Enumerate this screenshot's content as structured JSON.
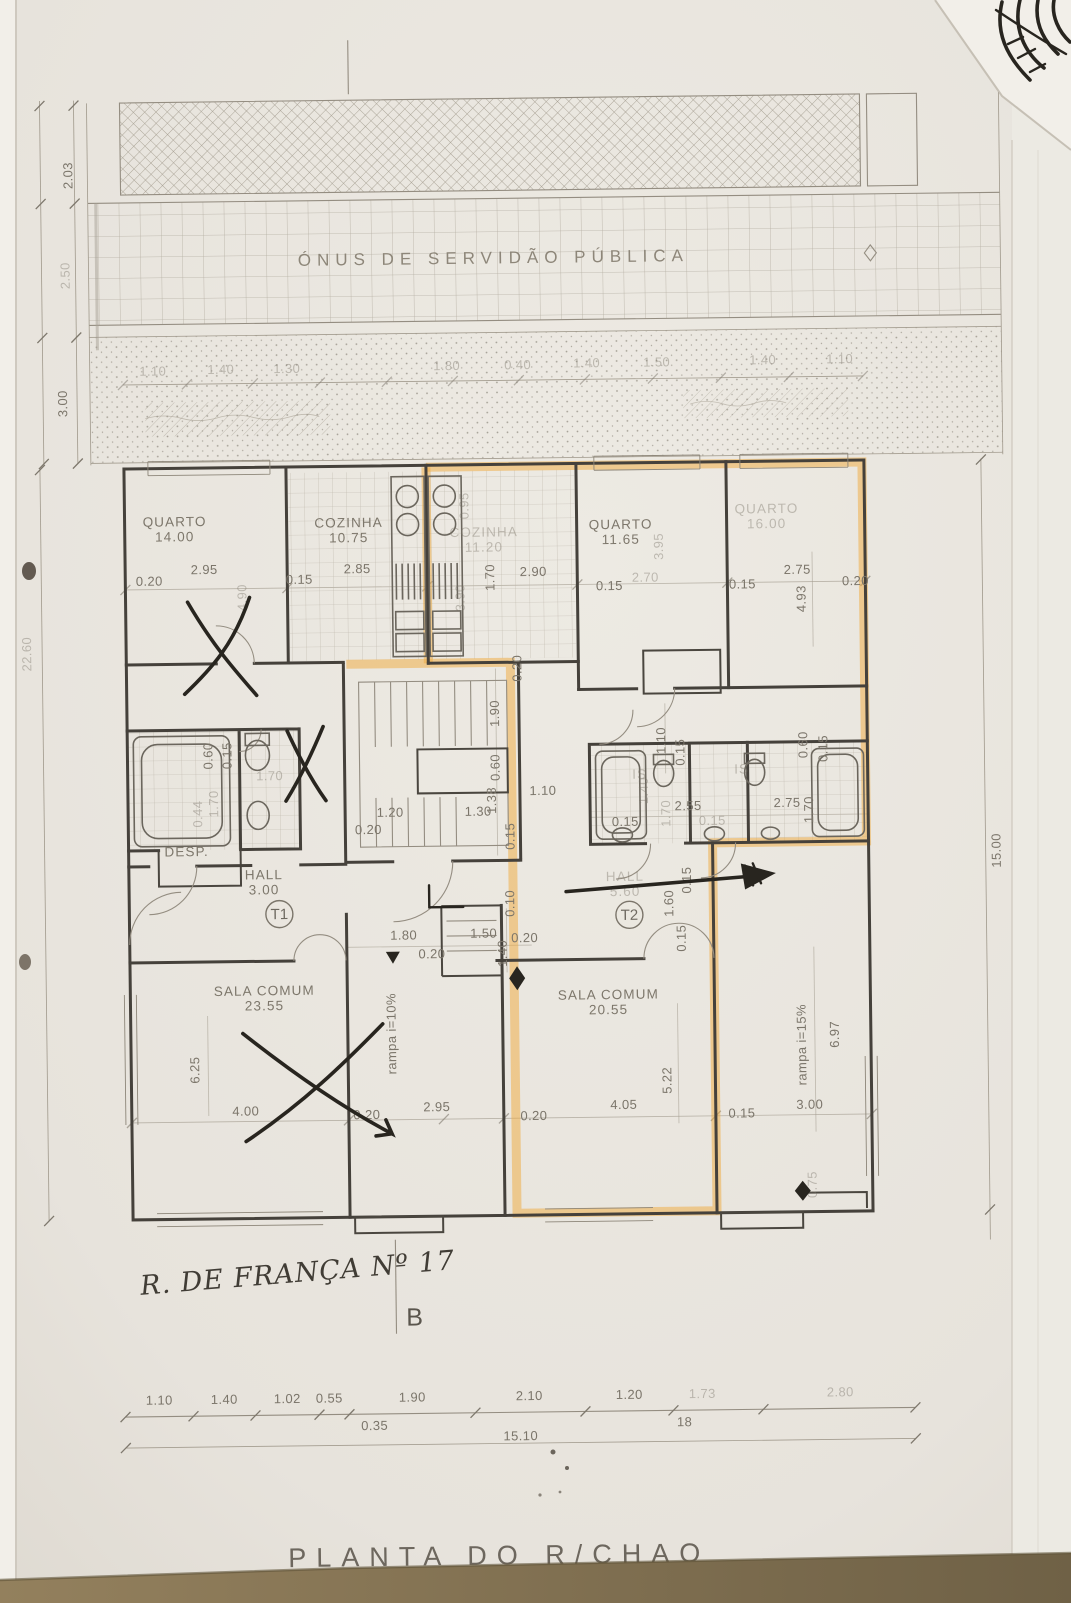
{
  "page": {
    "title": "PLANTA DO R/CHAO",
    "handwritten_note": "R. DE FRANÇA Nº 17",
    "section_marker": "B",
    "servitude_band_label": "ÓNUS DE SERVIDÃO PÚBLICA"
  },
  "rooms": [
    {
      "label": "QUARTO",
      "area": "14.00",
      "x": 178,
      "y": 522
    },
    {
      "label": "COZINHA",
      "area": "10.75",
      "x": 352,
      "y": 525
    },
    {
      "label": "COZINHA",
      "area": "11.20",
      "x": 487,
      "y": 536,
      "f": true
    },
    {
      "label": "QUARTO",
      "area": "11.65",
      "x": 624,
      "y": 530
    },
    {
      "label": "QUARTO",
      "area": "16.00",
      "x": 770,
      "y": 516,
      "f": true
    },
    {
      "label": "SALA COMUM",
      "area": "23.55",
      "x": 262,
      "y": 992
    },
    {
      "label": "SALA COMUM",
      "area": "20.55",
      "x": 606,
      "y": 1000
    },
    {
      "label": "HALL",
      "area": "3.00",
      "x": 263,
      "y": 876
    },
    {
      "label": "HALL",
      "area": "5.60",
      "x": 624,
      "y": 882,
      "f": true
    },
    {
      "label": "DESP.",
      "area": "",
      "x": 186,
      "y": 852
    },
    {
      "label": "IS",
      "area": "",
      "x": 640,
      "y": 780,
      "f": true
    },
    {
      "label": "IS",
      "area": "",
      "x": 742,
      "y": 776,
      "f": true
    }
  ],
  "unit_markers": [
    {
      "label": "T1",
      "x": 278,
      "y": 911
    },
    {
      "label": "T2",
      "x": 628,
      "y": 916
    }
  ],
  "ramp_labels": [
    {
      "label": "rampa i=10%",
      "x": 393,
      "y": 1032
    },
    {
      "label": "rampa i=15%",
      "x": 803,
      "y": 1048
    }
  ],
  "dimensions": [
    {
      "v": "2.03",
      "x": 80,
      "y": 170,
      "r": -90
    },
    {
      "v": "2.50",
      "x": 76,
      "y": 270,
      "r": -90,
      "f": true
    },
    {
      "v": "3.00",
      "x": 72,
      "y": 398,
      "r": -90
    },
    {
      "v": "22.60",
      "x": 33,
      "y": 648,
      "r": -90,
      "f": true
    },
    {
      "v": "15.00",
      "x": 1000,
      "y": 856,
      "r": -90
    },
    {
      "v": "1.10",
      "x": 158,
      "y": 371,
      "f": true
    },
    {
      "v": "1.40",
      "x": 226,
      "y": 370,
      "f": true
    },
    {
      "v": "1.30",
      "x": 292,
      "y": 370,
      "f": true
    },
    {
      "v": "1.80",
      "x": 452,
      "y": 369,
      "f": true
    },
    {
      "v": "0.40",
      "x": 523,
      "y": 369,
      "f": true
    },
    {
      "v": "1.40",
      "x": 592,
      "y": 368,
      "f": true
    },
    {
      "v": "1.50",
      "x": 662,
      "y": 368,
      "f": true
    },
    {
      "v": "1.40",
      "x": 768,
      "y": 367,
      "f": true
    },
    {
      "v": "1.10",
      "x": 845,
      "y": 367,
      "f": true
    },
    {
      "v": "0.20",
      "x": 152,
      "y": 581
    },
    {
      "v": "2.95",
      "x": 207,
      "y": 570
    },
    {
      "v": "4.90",
      "x": 249,
      "y": 594,
      "r": -90,
      "f": true
    },
    {
      "v": "0.15",
      "x": 302,
      "y": 581
    },
    {
      "v": "2.85",
      "x": 360,
      "y": 571
    },
    {
      "v": "3.90",
      "x": 467,
      "y": 597,
      "r": -90,
      "f": true
    },
    {
      "v": "1.70",
      "x": 497,
      "y": 577,
      "r": -90
    },
    {
      "v": "2.90",
      "x": 536,
      "y": 576
    },
    {
      "v": "0.95",
      "x": 472,
      "y": 505,
      "r": -90,
      "f": true
    },
    {
      "v": "0.15",
      "x": 612,
      "y": 591
    },
    {
      "v": "3.95",
      "x": 666,
      "y": 548,
      "r": -90,
      "f": true
    },
    {
      "v": "2.70",
      "x": 648,
      "y": 583,
      "f": true
    },
    {
      "v": "0.15",
      "x": 745,
      "y": 591
    },
    {
      "v": "2.75",
      "x": 800,
      "y": 577
    },
    {
      "v": "4.93",
      "x": 808,
      "y": 602,
      "r": -90
    },
    {
      "v": "0.20",
      "x": 858,
      "y": 589
    },
    {
      "v": "0.60",
      "x": 213,
      "y": 752,
      "r": -90
    },
    {
      "v": "0.15",
      "x": 232,
      "y": 752,
      "r": -90
    },
    {
      "v": "1.70",
      "x": 270,
      "y": 777,
      "f": true
    },
    {
      "v": "0.44",
      "x": 202,
      "y": 810,
      "r": -90,
      "f": true
    },
    {
      "v": "1.70",
      "x": 218,
      "y": 800,
      "r": -90,
      "f": true
    },
    {
      "v": "1.10",
      "x": 543,
      "y": 795
    },
    {
      "v": "0.20",
      "x": 523,
      "y": 668,
      "r": -90
    },
    {
      "v": "1.90",
      "x": 500,
      "y": 713,
      "r": -90
    },
    {
      "v": "0.60",
      "x": 500,
      "y": 767,
      "r": -90
    },
    {
      "v": "1.38",
      "x": 496,
      "y": 800,
      "r": -90
    },
    {
      "v": "1.20",
      "x": 390,
      "y": 815
    },
    {
      "v": "1.30",
      "x": 478,
      "y": 815
    },
    {
      "v": "0.20",
      "x": 368,
      "y": 832
    },
    {
      "v": "0.15",
      "x": 514,
      "y": 836,
      "r": -90
    },
    {
      "v": "1.10",
      "x": 666,
      "y": 742,
      "r": -90
    },
    {
      "v": "0.15",
      "x": 685,
      "y": 754,
      "r": -90
    },
    {
      "v": "1.40",
      "x": 648,
      "y": 792,
      "r": -90,
      "f": true
    },
    {
      "v": "2.55",
      "x": 688,
      "y": 812
    },
    {
      "v": "1.70",
      "x": 670,
      "y": 815,
      "r": -90,
      "f": true
    },
    {
      "v": "2.75",
      "x": 787,
      "y": 810
    },
    {
      "v": "1.70",
      "x": 813,
      "y": 813,
      "r": -90
    },
    {
      "v": "0.15",
      "x": 625,
      "y": 827
    },
    {
      "v": "0.15",
      "x": 712,
      "y": 827,
      "f": true
    },
    {
      "v": "0.60",
      "x": 808,
      "y": 748,
      "r": -90
    },
    {
      "v": "0.15",
      "x": 828,
      "y": 752,
      "r": -90
    },
    {
      "v": "1.80",
      "x": 402,
      "y": 938
    },
    {
      "v": "0.20",
      "x": 430,
      "y": 957
    },
    {
      "v": "1.50",
      "x": 482,
      "y": 937
    },
    {
      "v": "0.10",
      "x": 513,
      "y": 903,
      "r": -90
    },
    {
      "v": "1.40",
      "x": 505,
      "y": 953,
      "r": -90
    },
    {
      "v": "0.20",
      "x": 523,
      "y": 942
    },
    {
      "v": "1.60",
      "x": 672,
      "y": 905,
      "r": -90
    },
    {
      "v": "0.15",
      "x": 690,
      "y": 882,
      "r": -90
    },
    {
      "v": "0.15",
      "x": 684,
      "y": 940,
      "r": -90
    },
    {
      "v": "6.25",
      "x": 196,
      "y": 1066,
      "r": -90
    },
    {
      "v": "4.00",
      "x": 242,
      "y": 1112
    },
    {
      "v": "0.20",
      "x": 363,
      "y": 1117
    },
    {
      "v": "2.95",
      "x": 433,
      "y": 1110
    },
    {
      "v": "0.20",
      "x": 530,
      "y": 1120
    },
    {
      "v": "5.22",
      "x": 668,
      "y": 1082,
      "r": -90
    },
    {
      "v": "4.05",
      "x": 620,
      "y": 1110
    },
    {
      "v": "0.15",
      "x": 738,
      "y": 1120
    },
    {
      "v": "3.00",
      "x": 806,
      "y": 1112
    },
    {
      "v": "6.97",
      "x": 836,
      "y": 1038,
      "r": -90
    },
    {
      "v": "0.75",
      "x": 812,
      "y": 1188,
      "r": -90,
      "f": true
    },
    {
      "v": "1.10",
      "x": 152,
      "y": 1400
    },
    {
      "v": "1.40",
      "x": 217,
      "y": 1400
    },
    {
      "v": "1.02",
      "x": 280,
      "y": 1400
    },
    {
      "v": "0.55",
      "x": 322,
      "y": 1400
    },
    {
      "v": "1.90",
      "x": 405,
      "y": 1400
    },
    {
      "v": "2.10",
      "x": 522,
      "y": 1400
    },
    {
      "v": "1.20",
      "x": 622,
      "y": 1400
    },
    {
      "v": "1.73",
      "x": 695,
      "y": 1400,
      "f": true
    },
    {
      "v": "2.80",
      "x": 833,
      "y": 1400,
      "f": true
    },
    {
      "v": "0.35",
      "x": 367,
      "y": 1428
    },
    {
      "v": "18",
      "x": 677,
      "y": 1428
    },
    {
      "v": "15.10",
      "x": 513,
      "y": 1440
    }
  ]
}
